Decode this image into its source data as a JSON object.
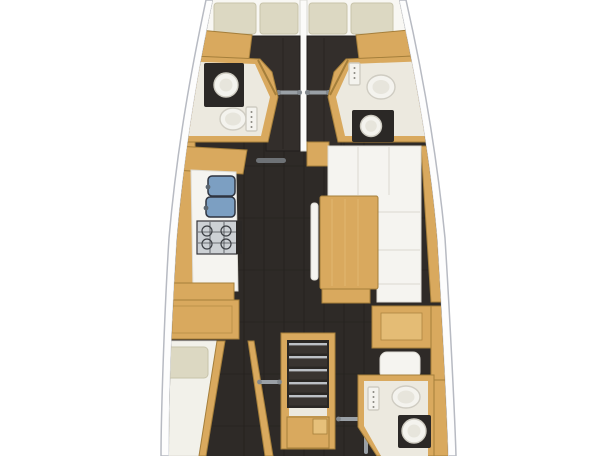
{
  "floor_plan": {
    "type": "sailing-yacht-interior-layout",
    "view": "top-down",
    "orientation": "bow-at-top, stern-at-bottom (cropped top and bottom)",
    "rooms": [
      {
        "id": "forward-cabin-port",
        "fixtures": [
          "dark-double-berth",
          "pillow",
          "pillow",
          "sliding-door-rail",
          "hull-side-cabinet"
        ]
      },
      {
        "id": "forward-head-port",
        "fixtures": [
          "washbasin-on-dark-counter",
          "toilet",
          "shower-control-panel",
          "angled-door"
        ]
      },
      {
        "id": "forward-cabin-starboard",
        "fixtures": [
          "dark-double-berth",
          "pillow",
          "pillow",
          "sliding-door-rail",
          "hull-side-cabinet"
        ]
      },
      {
        "id": "forward-head-starboard",
        "fixtures": [
          "toilet",
          "washbasin-on-dark-counter",
          "shower-control-panel",
          "angled-door"
        ]
      },
      {
        "id": "galley-port",
        "fixtures": [
          "double-sink-blue",
          "stove-cooktop",
          "white-worktop",
          "hull-side-cabinetry",
          "storage-base"
        ]
      },
      {
        "id": "salon-starboard",
        "fixtures": [
          "l-shaped-white-settee",
          "wood-dining-table",
          "slim-bench",
          "corner-cabinet",
          "hull-side-trim"
        ]
      },
      {
        "id": "companionway-center",
        "fixtures": [
          "five-step-stairs",
          "landing",
          "engine-compartment-box",
          "handrail-left",
          "handrail-right",
          "handrail-vertical"
        ]
      },
      {
        "id": "aft-cabin-port",
        "fixtures": [
          "berth-mattress",
          "pillow",
          "overhead-cabinet",
          "angled-partition"
        ]
      },
      {
        "id": "aft-desk-starboard",
        "fixtures": [
          "desk-cabinet",
          "white-seat",
          "hull-side-wardrobe"
        ]
      },
      {
        "id": "aft-head-starboard",
        "fixtures": [
          "toilet",
          "washbasin-on-dark-counter",
          "shower-control-panel",
          "angled-wall"
        ]
      }
    ],
    "floor_finish": "dark espresso planks with seam grid",
    "counts": {
      "forward_pillows": 4,
      "aft_pillows": 1,
      "toilets": 3,
      "washbasins": 3,
      "stair_steps": 5
    }
  },
  "palette": {
    "bg": "#ffffff",
    "hull_fill": "#fdfdfd",
    "hull_stroke": "#b7bac2",
    "hull_inner": "#d3d6dc",
    "deck": "#f8f7f3",
    "floor": "#2e2a27",
    "floor_seam": "#1c1916",
    "bed": "#332e2b",
    "bed_edge": "#211e1c",
    "divider": "#fbfbf9",
    "wood": "#d9a95e",
    "wood_dark": "#a57f3b",
    "wood_light": "#e6c07a",
    "white_surface": "#f5f4f0",
    "surface_edge": "#dddbd4",
    "cream": "#ece9df",
    "mattress": "#f2f1ea",
    "pillow": "#dcd8c2",
    "pillow_edge": "#c7c3aa",
    "counter": "#2b2826",
    "fixture": "#f4f3ee",
    "fixture_edge": "#cfccc2",
    "fixture_inner": "#e7e5dc",
    "sink_blue": "#7c9fc2",
    "sink_edge": "#2e3440",
    "steel": "#cdd1d5",
    "steel_line": "#4a4d52",
    "metal": "#9aa0a6",
    "metal_dark": "#82888e",
    "hatch": "#6e7276"
  }
}
